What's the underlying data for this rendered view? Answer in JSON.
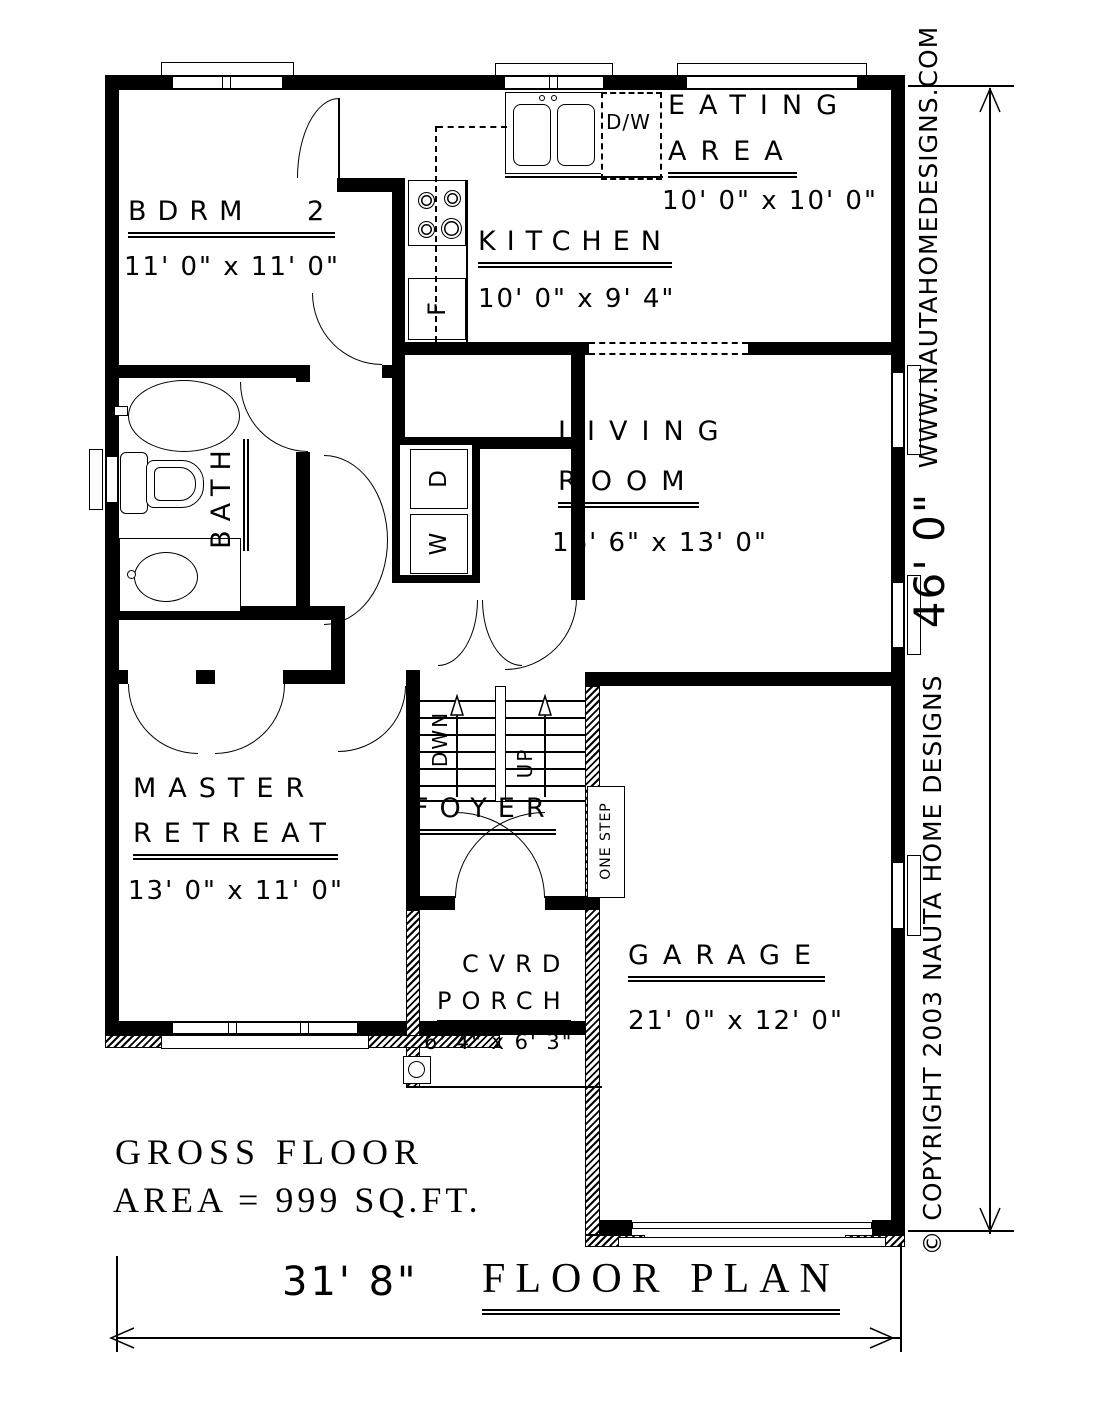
{
  "rooms": {
    "bdrm2": {
      "name": "BDRM 2",
      "dims": "11' 0\" x 11' 0\""
    },
    "eating": {
      "line1": "EATING",
      "line2": "AREA",
      "dims": "10' 0\" x 10' 0\""
    },
    "kitchen": {
      "name": "KITCHEN",
      "dims": "10' 0\" x 9' 4\""
    },
    "living": {
      "line1": "LIVING",
      "line2": "ROOM",
      "dims": "16' 6\" x 13' 0\""
    },
    "bath": {
      "name": "BATH"
    },
    "master": {
      "line1": "MASTER",
      "line2": "RETREAT",
      "dims": "13' 0\" x 11' 0\""
    },
    "foyer": {
      "name": "FOYER"
    },
    "porch": {
      "line1": "CVRD",
      "line2": "PORCH",
      "dims": "6' 4\" x 6' 3\""
    },
    "garage": {
      "name": "GARAGE",
      "dims": "21' 0\" x 12' 0\""
    }
  },
  "fixtures": {
    "dishwasher": "D/W",
    "fridge": "F",
    "dryer": "D",
    "washer": "W",
    "stairs_down": "DWN",
    "stairs_up": "UP",
    "one_step": "ONE STEP"
  },
  "annotations": {
    "gross_area_line1": "GROSS FLOOR",
    "gross_area_line2": "AREA = 999 SQ.FT.",
    "plan_title": "FLOOR PLAN",
    "width_dim": "31' 8\"",
    "height_dim": "46' 0\"",
    "website": "WWW.NAUTAHOMEDESIGNS.COM",
    "copyright": "© COPYRIGHT 2003 NAUTA HOME DESIGNS"
  }
}
